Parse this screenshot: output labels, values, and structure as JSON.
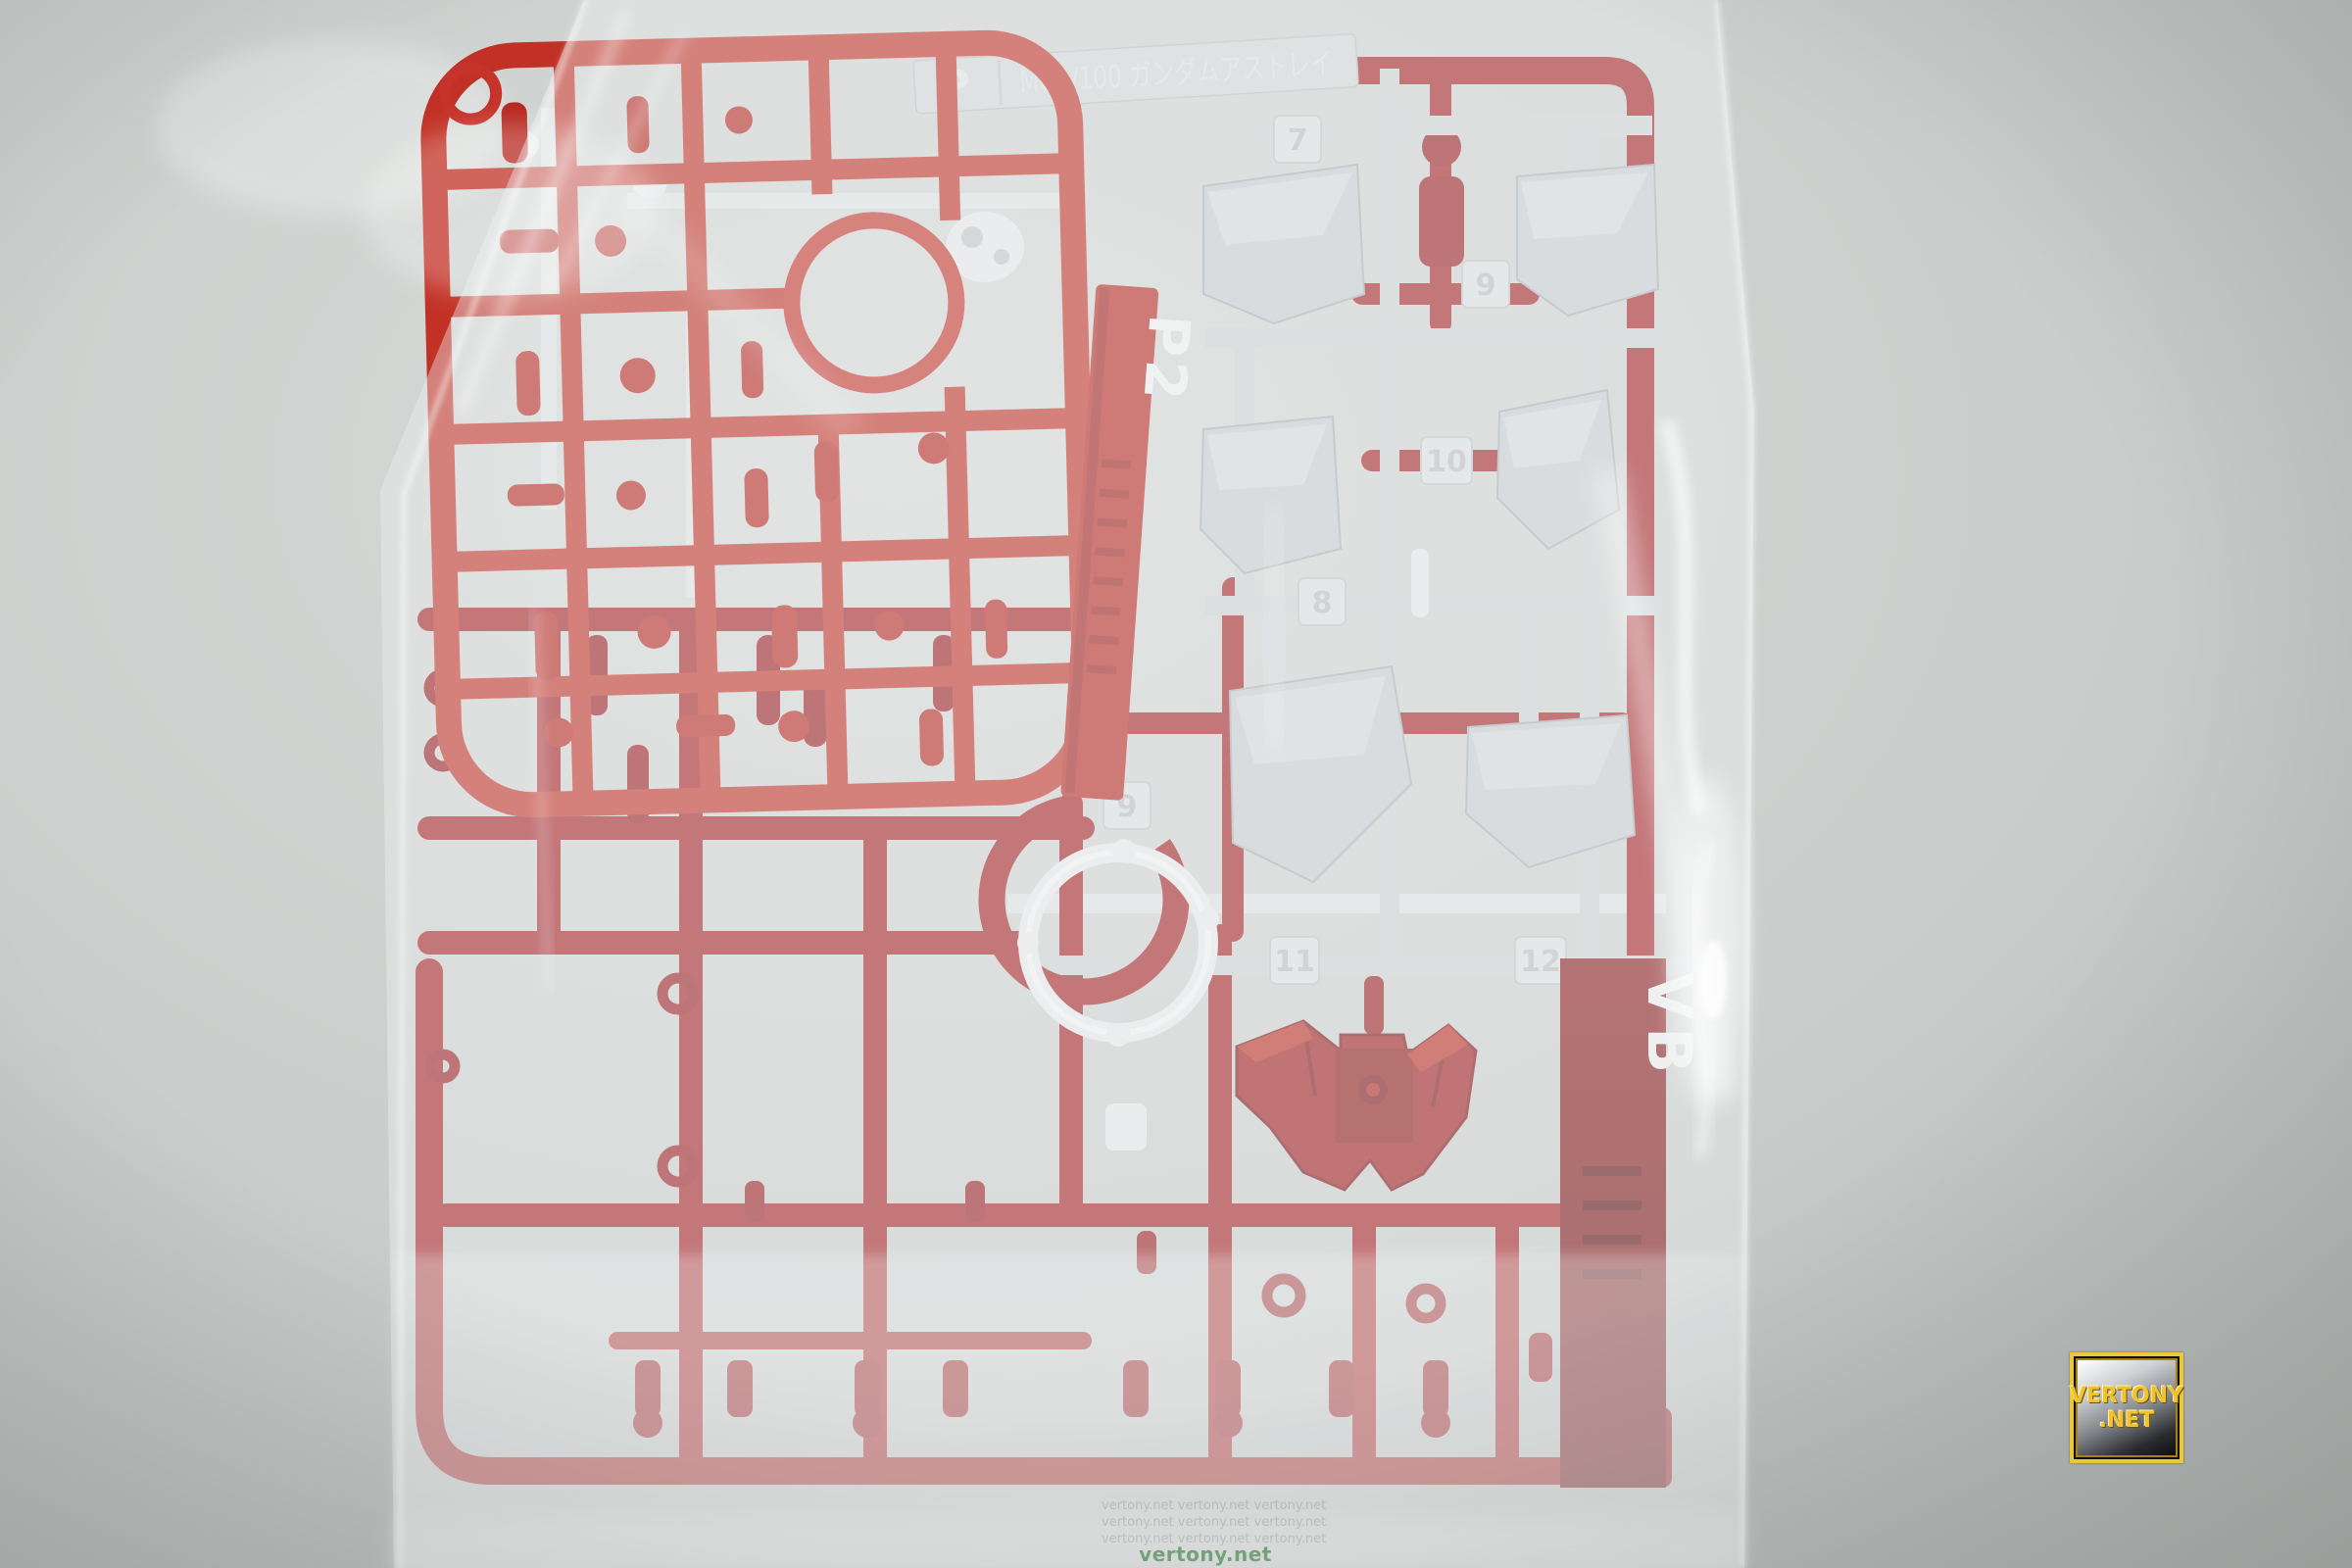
{
  "runner": {
    "plate_letter": "P",
    "plate_title": "MG1/100 ガンダムアストレイ",
    "vertical_tag": "P2",
    "side_tag": "VB",
    "part_numbers": [
      "7",
      "9",
      "10",
      "8",
      "9",
      "11",
      "12"
    ]
  },
  "watermark": {
    "line1": "VERTONY",
    "line2": ".NET",
    "footer": "vertony.net",
    "footer_repeat": "vertony.net  vertony.net  vertony.net"
  },
  "colors": {
    "background_gray": "#c6cac8",
    "bag_white": "#eef1f1",
    "red_bright": "#c23126",
    "red_main": "#a42024",
    "red_deep": "#7c1215",
    "gray_part": "#c9cdd0",
    "white_plastic": "#e9ebec",
    "watermark_gold": "#f0c22e",
    "footer_green": "#2f7d3c"
  }
}
